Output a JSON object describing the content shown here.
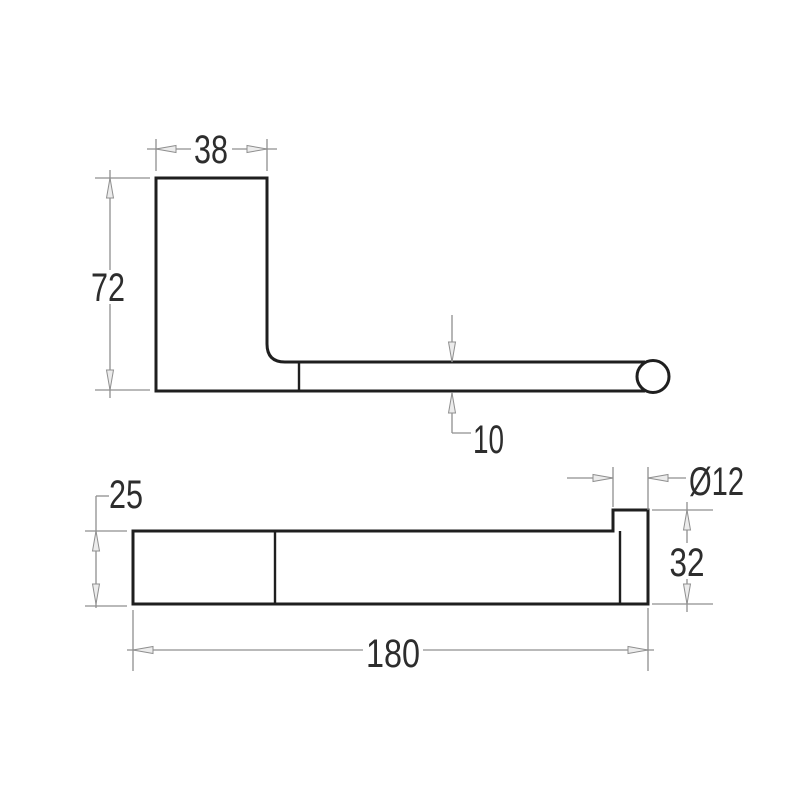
{
  "drawing": {
    "side_view": {
      "bracket_width_mm": "38",
      "bracket_height_mm": "72",
      "arm_thickness_mm": "10"
    },
    "plan_view": {
      "plate_depth_mm": "25",
      "rod_diameter_mm": "Ø12",
      "end_height_mm": "32",
      "overall_length_mm": "180"
    },
    "colors": {
      "background": "#ffffff",
      "outline": "#1f1f1f",
      "dimension_lines": "#8f8f8f",
      "text": "#2d2d2d"
    }
  }
}
